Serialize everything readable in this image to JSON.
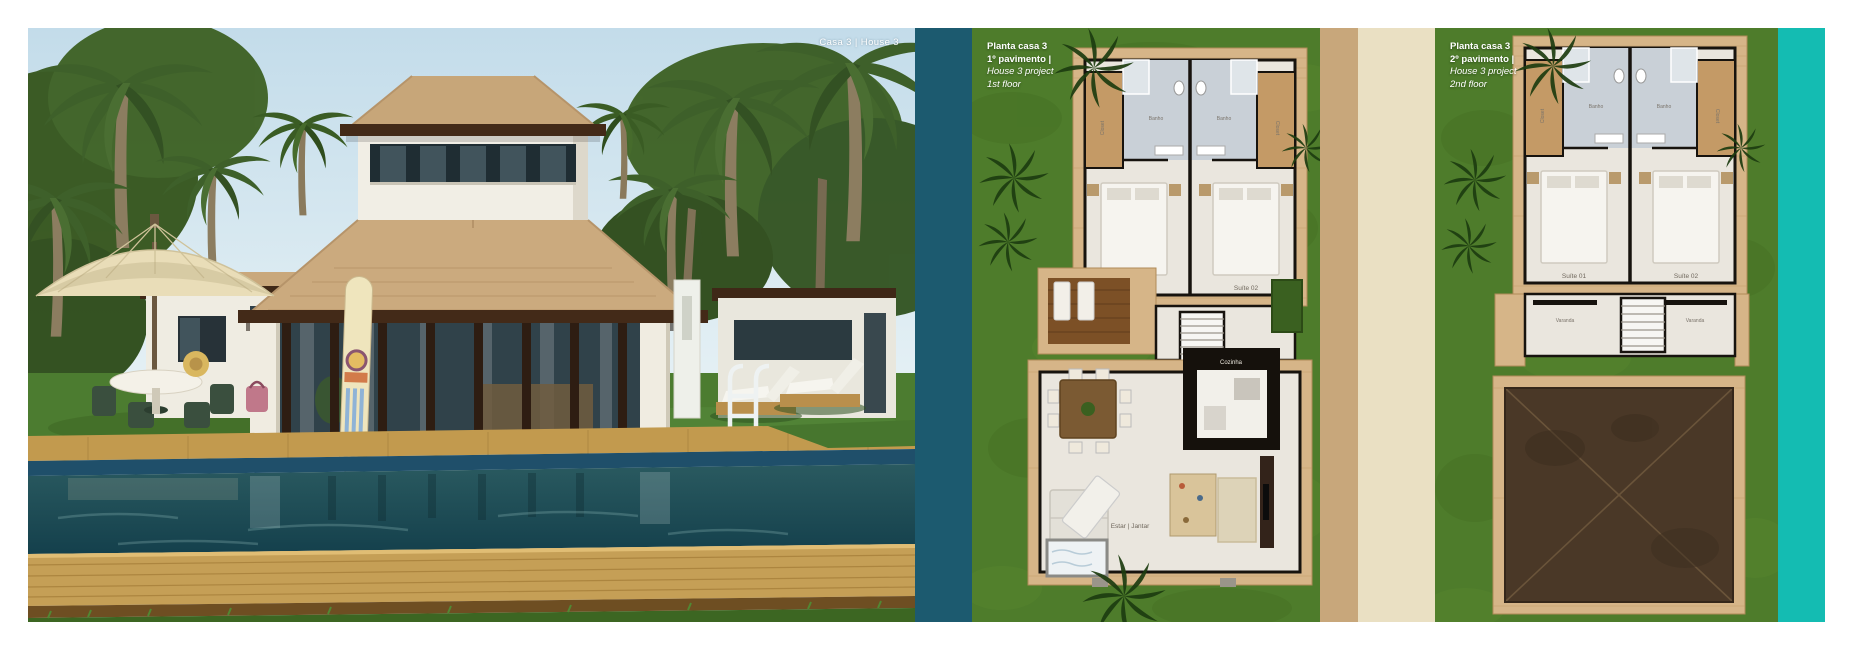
{
  "photo": {
    "caption": "Casa 3 | House 3"
  },
  "plan1": {
    "title_lines": [
      "Planta casa 3",
      "1º pavimento |",
      "House 3 project",
      "1st floor"
    ]
  },
  "plan2": {
    "title_lines": [
      "Planta casa 3",
      "2º pavimento |",
      "House 3 project",
      "2nd floor"
    ]
  },
  "rooms": {
    "banho": "Banho",
    "closet": "Closet",
    "suite1": "Suíte 01",
    "suite2": "Suíte 02",
    "varanda": "Varanda",
    "cozinha": "Cozinha",
    "estar": "Estar | Jantar"
  },
  "colors": {
    "teal-band": "#1c5a6f",
    "cyan-band": "#14bcb2",
    "tan-strip": "#c8a77b",
    "cream-strip": "#eae0c3",
    "plan-grass": "#4e7c2b",
    "deck-wood": "#d6b588",
    "plan-floor": "#eae6de",
    "plan-wall": "#17130e",
    "bath-floor": "#c9d0d7",
    "roof-top": "#4a3827",
    "pool-water": "#1d4a52",
    "photo-deck": "#c59f56"
  }
}
